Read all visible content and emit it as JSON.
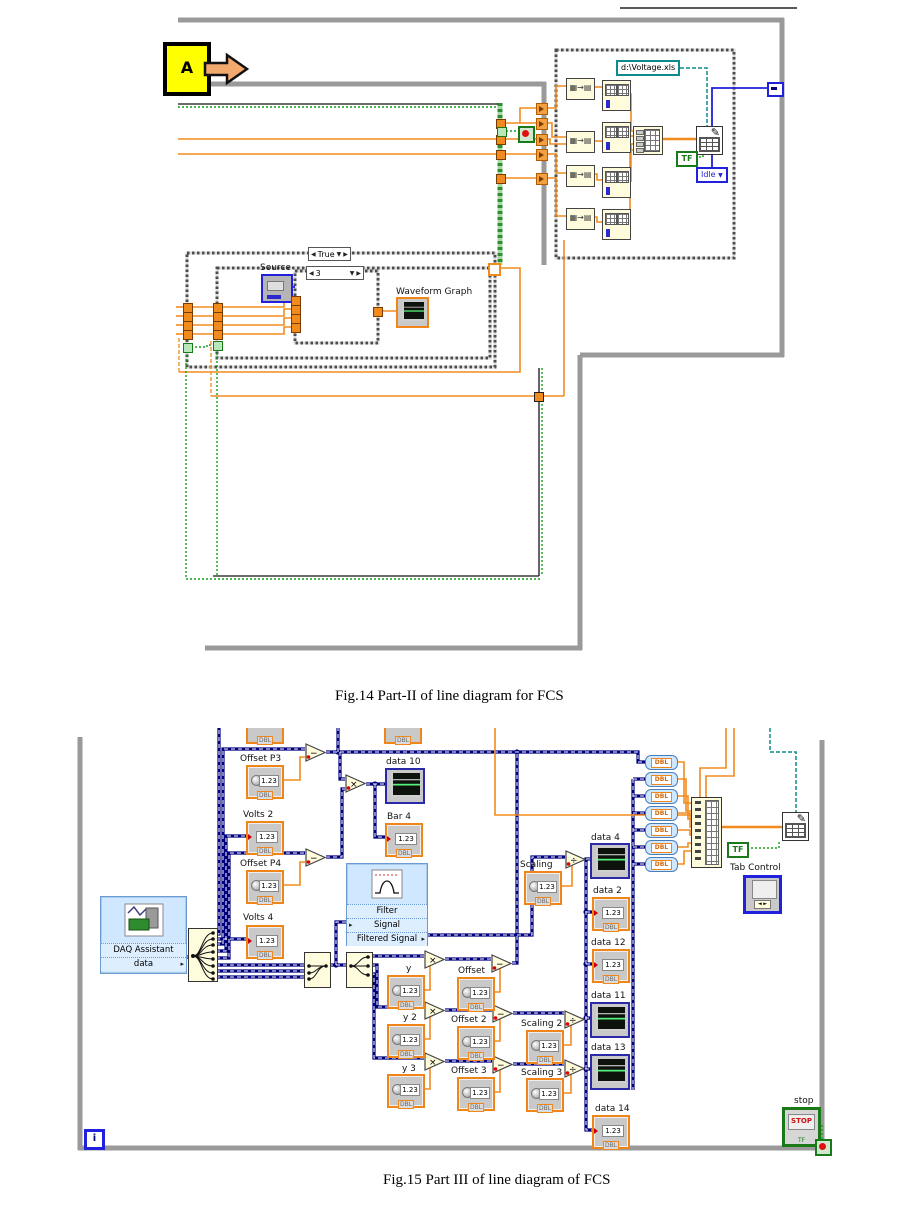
{
  "captions": {
    "fig14": "Fig.14 Part-II of line diagram for FCS",
    "fig15": "Fig.15 Part III of line diagram of FCS"
  },
  "colors": {
    "wire_orange": "#f28b1e",
    "wire_navy": "#00007e",
    "wire_green": "#17a017",
    "wire_teal": "#0f8a8a",
    "wire_blue": "#2020dd",
    "express_blue": "#cfe8ff",
    "node_beige": "#fffcde",
    "border_gray": "#9a9a9a",
    "control_orange": "#f08519",
    "indicator_navy": "#2a2aa8",
    "stop_red": "#d01010",
    "marker_yellow": "#ffff00"
  },
  "icons": {
    "multiply": "×",
    "subtract": "−",
    "divide": "÷",
    "build_array": "▦→▤",
    "write_file": "✎",
    "selector_left": "◀",
    "selector_right": "▶",
    "selector_down": "▼",
    "io_arrow": "▸",
    "io_arrow_left": "▸",
    "tab_arrows": "◄ ►",
    "enum_down": "▼"
  },
  "f14": {
    "marker": "A",
    "case_selector": "True",
    "inner_case_selector": "3",
    "source": "Source",
    "waveform_graph": "Waveform Graph",
    "file_path": "d:\\Voltage.xls",
    "bool_const": "TF",
    "state_enum": "Idle"
  },
  "f15": {
    "value": "1.23",
    "dbl": "DBL",
    "labels": {
      "offset_p3": "Offset P3",
      "volts_2": "Volts 2",
      "offset_p4": "Offset P4",
      "volts_4": "Volts 4",
      "daq_title": "DAQ Assistant",
      "daq_output": "data",
      "data_10": "data 10",
      "bar_4": "Bar 4",
      "filter_title": "Filter",
      "filter_in": "Signal",
      "filter_out": "Filtered Signal",
      "scaling": "Scaling",
      "y": "y",
      "y_2": "y 2",
      "y_3": "y 3",
      "offset": "Offset",
      "offset_2": "Offset 2",
      "offset_3": "Offset 3",
      "scaling_2": "Scaling 2",
      "scaling_3": "Scaling 3",
      "data_4": "data 4",
      "data_2": "data 2",
      "data_12": "data 12",
      "data_11": "data 11",
      "data_13": "data 13",
      "data_14": "data 14",
      "tab_control": "Tab Control",
      "stop": "stop",
      "stop_button": "STOP",
      "bool_const": "TF",
      "iteration": "i"
    }
  }
}
